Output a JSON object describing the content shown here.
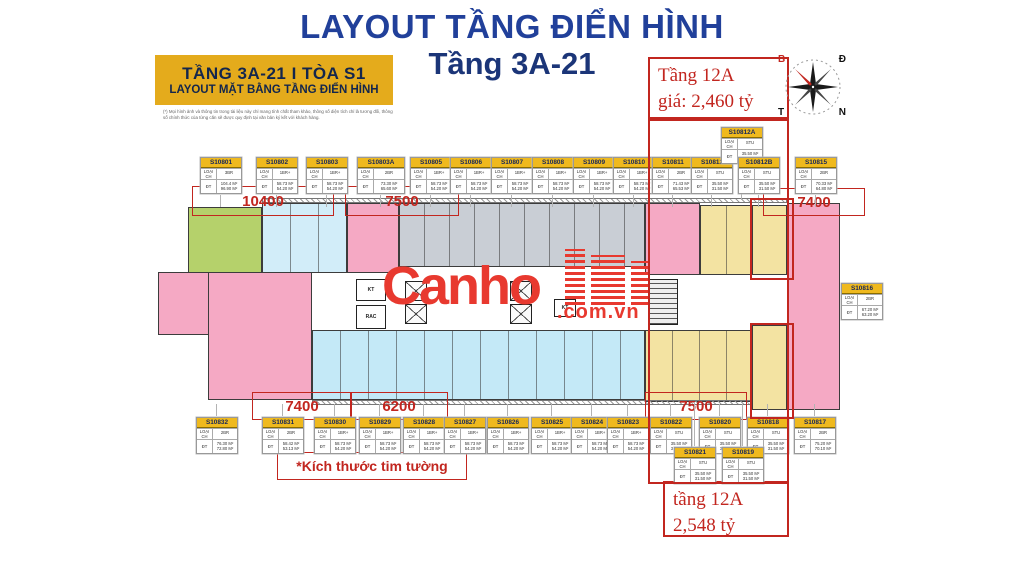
{
  "header": {
    "main_title": "LAYOUT TẦNG ĐIỂN HÌNH",
    "sub_title": "Tầng 3A-21"
  },
  "info_box": {
    "line1": "TẦNG  3A-21  I  TÒA S1",
    "line2": "LAYOUT MẶT BẰNG TẦNG ĐIỂN HÌNH",
    "disclaimer": "(*) Mọi hình ảnh và thông tin trong tài liệu này chỉ mang tính chất tham khảo, thông số diện tích chỉ là tương đối, thông số chính thức của từng căn sẽ được quy định tại văn bản ký kết với khách hàng."
  },
  "annotations": {
    "top_box": {
      "line1": "Tầng 12A",
      "line2": "giá: 2,460 tỷ"
    },
    "bottom_box": {
      "line1": "tầng 12A",
      "line2": "2,548 tỷ"
    },
    "note": "*Kích thước tim tường"
  },
  "watermark": {
    "text": "Canho",
    "suffix": ".com.vn"
  },
  "compass": {
    "top_left": "B",
    "top_right": "Đ",
    "bottom_left": "T",
    "bottom_right": "N"
  },
  "card_labels": {
    "type": "LOẠI CH",
    "area": "ĐT"
  },
  "dimensions": [
    {
      "label": "10400",
      "x": 192,
      "y": 186,
      "w": 140,
      "h": 28
    },
    {
      "label": "7500",
      "x": 345,
      "y": 186,
      "w": 112,
      "h": 28
    },
    {
      "label": "7400",
      "x": 763,
      "y": 188,
      "w": 100,
      "h": 26
    },
    {
      "label": "7400",
      "x": 252,
      "y": 392,
      "w": 98,
      "h": 26
    },
    {
      "label": "6200",
      "x": 350,
      "y": 392,
      "w": 96,
      "h": 26
    },
    {
      "label": "7500",
      "x": 645,
      "y": 392,
      "w": 100,
      "h": 26
    }
  ],
  "units": [
    {
      "id": "S10801",
      "type": "3BR",
      "area1": "104.4 M²",
      "area2": "96.90 M²",
      "x": 200,
      "y": 157,
      "leader": [
        195,
        207
      ]
    },
    {
      "id": "S10802",
      "type": "1BR+",
      "area1": "58.73 M²",
      "area2": "54.20 M²",
      "x": 256,
      "y": 157,
      "leader": [
        195,
        207
      ]
    },
    {
      "id": "S10803",
      "type": "1BR+",
      "area1": "58.73 M²",
      "area2": "54.20 M²",
      "x": 306,
      "y": 157,
      "leader": [
        195,
        207
      ]
    },
    {
      "id": "S10803A",
      "type": "2BR",
      "area1": "73.30 M²",
      "area2": "65.60 M²",
      "x": 357,
      "y": 157,
      "w": 46,
      "leader": [
        195,
        207
      ]
    },
    {
      "id": "S10805",
      "type": "1BR+",
      "area1": "58.73 M²",
      "area2": "54.20 M²",
      "x": 410,
      "y": 157,
      "leader": [
        195,
        207
      ]
    },
    {
      "id": "S10806",
      "type": "1BR+",
      "area1": "58.73 M²",
      "area2": "54.20 M²",
      "x": 450,
      "y": 157,
      "leader": [
        195,
        207
      ]
    },
    {
      "id": "S10807",
      "type": "1BR+",
      "area1": "58.73 M²",
      "area2": "54.20 M²",
      "x": 491,
      "y": 157,
      "leader": [
        195,
        207
      ]
    },
    {
      "id": "S10808",
      "type": "1BR+",
      "area1": "58.73 M²",
      "area2": "54.20 M²",
      "x": 532,
      "y": 157,
      "leader": [
        195,
        207
      ]
    },
    {
      "id": "S10809",
      "type": "1BR+",
      "area1": "58.73 M²",
      "area2": "54.20 M²",
      "x": 573,
      "y": 157,
      "leader": [
        195,
        207
      ]
    },
    {
      "id": "S10810",
      "type": "1BR+",
      "area1": "58.73 M²",
      "area2": "54.20 M²",
      "x": 613,
      "y": 157,
      "leader": [
        195,
        207
      ]
    },
    {
      "id": "S10811",
      "type": "2BR",
      "area1": "71.43 M²",
      "area2": "65.53 M²",
      "x": 652,
      "y": 157,
      "leader": [
        195,
        207
      ]
    },
    {
      "id": "S10812",
      "type": "STU",
      "area1": "35.50 M²",
      "area2": "31.50 M²",
      "x": 691,
      "y": 157,
      "leader": [
        195,
        207
      ]
    },
    {
      "id": "S10812A",
      "type": "STU",
      "area1": "35.50 M²",
      "area2": "31.50 M²",
      "x": 721,
      "y": 127,
      "leader": [
        165,
        200
      ]
    },
    {
      "id": "S10812B",
      "type": "STU",
      "area1": "35.50 M²",
      "area2": "31.50 M²",
      "x": 738,
      "y": 157,
      "leader": [
        195,
        207
      ]
    },
    {
      "id": "S10815",
      "type": "2BR",
      "area1": "70.33 M²",
      "area2": "64.80 M²",
      "x": 795,
      "y": 157,
      "leader": [
        195,
        207
      ]
    },
    {
      "id": "S10816",
      "type": "2BR",
      "area1": "67.20 M²",
      "area2": "63.20 M²",
      "x": 841,
      "y": 283
    },
    {
      "id": "S10832",
      "type": "2BR",
      "area1": "76.30 M²",
      "area2": "72.80 M²",
      "x": 196,
      "y": 417,
      "leader": [
        404,
        416
      ]
    },
    {
      "id": "S10831",
      "type": "2BR",
      "area1": "58.42 M²",
      "area2": "53.13 M²",
      "x": 262,
      "y": 417,
      "leader": [
        404,
        416
      ]
    },
    {
      "id": "S10830",
      "type": "1BR+",
      "area1": "58.73 M²",
      "area2": "54.20 M²",
      "x": 314,
      "y": 417,
      "leader": [
        404,
        416
      ]
    },
    {
      "id": "S10829",
      "type": "1BR+",
      "area1": "58.73 M²",
      "area2": "54.20 M²",
      "x": 359,
      "y": 417,
      "leader": [
        404,
        416
      ]
    },
    {
      "id": "S10828",
      "type": "1BR+",
      "area1": "58.73 M²",
      "area2": "54.20 M²",
      "x": 403,
      "y": 417,
      "leader": [
        404,
        416
      ]
    },
    {
      "id": "S10827",
      "type": "1BR+",
      "area1": "58.73 M²",
      "area2": "54.20 M²",
      "x": 444,
      "y": 417,
      "leader": [
        404,
        416
      ]
    },
    {
      "id": "S10826",
      "type": "1BR+",
      "area1": "58.73 M²",
      "area2": "54.20 M²",
      "x": 487,
      "y": 417,
      "leader": [
        404,
        416
      ]
    },
    {
      "id": "S10825",
      "type": "1BR+",
      "area1": "58.73 M²",
      "area2": "54.20 M²",
      "x": 531,
      "y": 417,
      "leader": [
        404,
        416
      ]
    },
    {
      "id": "S10824",
      "type": "1BR+",
      "area1": "58.73 M²",
      "area2": "54.20 M²",
      "x": 571,
      "y": 417,
      "leader": [
        404,
        416
      ]
    },
    {
      "id": "S10823",
      "type": "1BR+",
      "area1": "58.73 M²",
      "area2": "54.20 M²",
      "x": 607,
      "y": 417,
      "leader": [
        404,
        416
      ]
    },
    {
      "id": "S10822",
      "type": "STU",
      "area1": "35.50 M²",
      "area2": "31.50 M²",
      "x": 650,
      "y": 417,
      "leader": [
        404,
        416
      ]
    },
    {
      "id": "S10820",
      "type": "STU",
      "area1": "35.50 M²",
      "area2": "31.50 M²",
      "x": 699,
      "y": 417,
      "leader": [
        404,
        416
      ]
    },
    {
      "id": "S10818",
      "type": "STU",
      "area1": "35.50 M²",
      "area2": "31.50 M²",
      "x": 747,
      "y": 417,
      "leader": [
        404,
        416
      ]
    },
    {
      "id": "S10817",
      "type": "2BR",
      "area1": "75.20 M²",
      "area2": "70.10 M²",
      "x": 794,
      "y": 417,
      "leader": [
        404,
        416
      ]
    },
    {
      "id": "S10821",
      "type": "STU",
      "area1": "35.50 M²",
      "area2": "31.50 M²",
      "x": 674,
      "y": 447,
      "leader": [
        402,
        446
      ]
    },
    {
      "id": "S10819",
      "type": "STU",
      "area1": "35.50 M²",
      "area2": "31.50 M²",
      "x": 722,
      "y": 447,
      "leader": [
        402,
        446
      ]
    }
  ],
  "plan": {
    "palette": {
      "green": "#b5d16b",
      "blue": "#d2edf9",
      "cyan": "#c4e9f7",
      "pink": "#f5a9c4",
      "yellow": "#f3e3a2",
      "gray": "#c9ced5"
    },
    "blocks": [
      {
        "name": "unit-green-corner",
        "color": "green",
        "x": 30,
        "y": 12,
        "w": 74,
        "h": 78
      },
      {
        "name": "units-blue-top",
        "color": "blue",
        "x": 104,
        "y": 8,
        "w": 85,
        "h": 70,
        "div": 28
      },
      {
        "name": "unit-pink-top-left",
        "color": "pink",
        "x": 189,
        "y": 8,
        "w": 52,
        "h": 70
      },
      {
        "name": "units-gray-top-middle",
        "color": "gray",
        "x": 241,
        "y": 8,
        "w": 246,
        "h": 64,
        "div": 25
      },
      {
        "name": "unit-pink-top-mid",
        "color": "pink",
        "x": 487,
        "y": 8,
        "w": 55,
        "h": 72
      },
      {
        "name": "units-yellow-top",
        "color": "yellow",
        "x": 542,
        "y": 10,
        "w": 52,
        "h": 70,
        "div": 26
      },
      {
        "name": "unit-yellow-top-hl",
        "color": "yellow",
        "x": 594,
        "y": 10,
        "w": 35,
        "h": 70
      },
      {
        "name": "unit-pink-right-column",
        "color": "pink",
        "x": 629,
        "y": 8,
        "w": 53,
        "h": 207
      },
      {
        "name": "unit-pink-left-strip",
        "color": "pink",
        "x": 0,
        "y": 77,
        "w": 52,
        "h": 63
      },
      {
        "name": "unit-pink-bottom-left",
        "color": "pink",
        "x": 50,
        "y": 77,
        "w": 104,
        "h": 128
      },
      {
        "name": "units-cyan-bottom",
        "color": "cyan",
        "x": 154,
        "y": 135,
        "w": 333,
        "h": 70,
        "div": 28
      },
      {
        "name": "units-yellow-bottom",
        "color": "yellow",
        "x": 487,
        "y": 135,
        "w": 107,
        "h": 72,
        "div": 27
      },
      {
        "name": "unit-yellow-bottom-hl",
        "color": "yellow",
        "x": 594,
        "y": 130,
        "w": 35,
        "h": 85
      }
    ],
    "lifts": [
      {
        "x": 247,
        "y": 86,
        "w": 22,
        "h": 20
      },
      {
        "x": 247,
        "y": 109,
        "w": 22,
        "h": 20
      },
      {
        "x": 352,
        "y": 86,
        "w": 22,
        "h": 20
      },
      {
        "x": 352,
        "y": 109,
        "w": 22,
        "h": 20
      }
    ],
    "core_labels": [
      {
        "text": "KT",
        "x": 198,
        "y": 84,
        "w": 30,
        "h": 22
      },
      {
        "text": "RAC",
        "x": 198,
        "y": 110,
        "w": 30,
        "h": 24
      },
      {
        "text": "KT",
        "x": 396,
        "y": 104,
        "w": 22,
        "h": 18
      }
    ],
    "hatches": [
      {
        "x": 104,
        "y": 3,
        "w": 525,
        "h": 5
      },
      {
        "x": 154,
        "y": 205,
        "w": 440,
        "h": 5
      }
    ],
    "stairs": {
      "x": 490,
      "y": 84,
      "w": 30,
      "h": 46
    }
  },
  "highlight_rects": [
    {
      "x": 750,
      "y": 198,
      "w": 40,
      "h": 78
    },
    {
      "x": 750,
      "y": 323,
      "w": 40,
      "h": 92
    }
  ],
  "connector_rect": {
    "x": 648,
    "y": 119,
    "w": 137,
    "h": 361
  }
}
